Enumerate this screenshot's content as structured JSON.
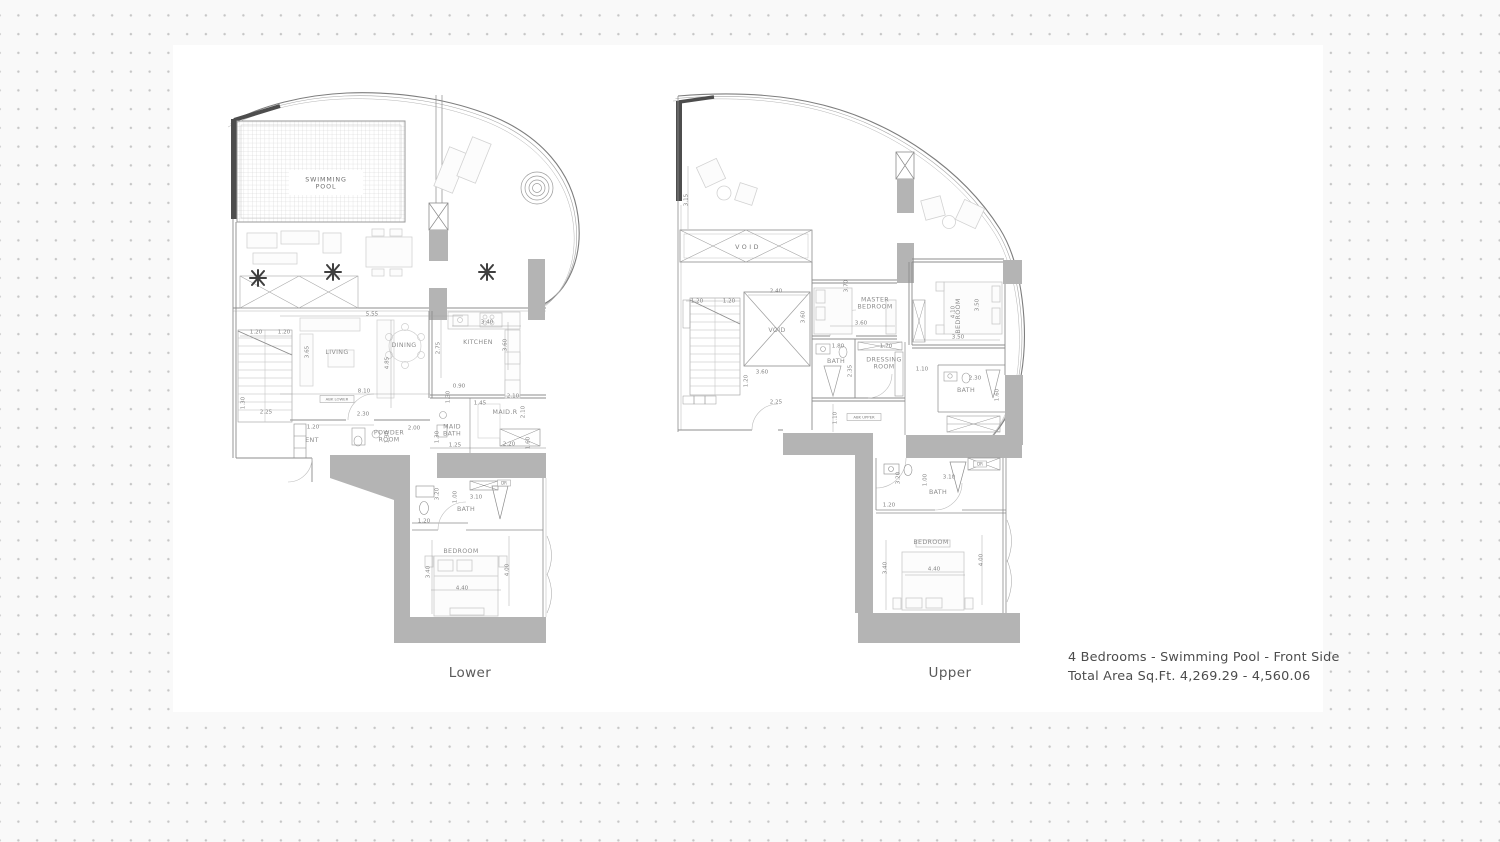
{
  "footer": {
    "line1": "4 Bedrooms - Swimming Pool - Front Side",
    "line2": "Total Area Sq.Ft.  4,269.29 - 4,560.06"
  },
  "plans": [
    {
      "caption": "Lower",
      "rooms": [
        {
          "label": "SWIMMING POOL",
          "lines": [
            "SWIMMING",
            "POOL"
          ],
          "x": 326,
          "y": 183,
          "size": 6.8,
          "cls": "poolname"
        },
        {
          "label": "LIVING",
          "x": 337,
          "y": 352
        },
        {
          "label": "DINING",
          "x": 404,
          "y": 345
        },
        {
          "label": "KITCHEN",
          "x": 478,
          "y": 342
        },
        {
          "label": "MAID.R",
          "x": 505,
          "y": 412,
          "size": 5.4
        },
        {
          "label": "MAID BATH",
          "lines": [
            "MAID",
            "BATH"
          ],
          "x": 452,
          "y": 430,
          "size": 4.8
        },
        {
          "label": "POWDER ROOM",
          "lines": [
            "POWDER",
            "ROOM"
          ],
          "x": 389,
          "y": 436,
          "size": 5.2
        },
        {
          "label": "ENT",
          "x": 312,
          "y": 440,
          "size": 5.2
        },
        {
          "label": "BATH",
          "x": 466,
          "y": 509,
          "size": 5.2
        },
        {
          "label": "BEDROOM",
          "x": 461,
          "y": 551
        }
      ],
      "dims": [
        {
          "t": "1.20",
          "x": 256,
          "y": 332
        },
        {
          "t": "1.20",
          "x": 284,
          "y": 332
        },
        {
          "t": "5.55",
          "x": 372,
          "y": 314
        },
        {
          "t": "3.40",
          "x": 487,
          "y": 322
        },
        {
          "t": "2.75",
          "x": 438,
          "y": 348,
          "rot": -90
        },
        {
          "t": "4.85",
          "x": 387,
          "y": 363,
          "rot": -90
        },
        {
          "t": "3.65",
          "x": 307,
          "y": 352,
          "rot": -90
        },
        {
          "t": "3.60",
          "x": 505,
          "y": 345,
          "rot": -90
        },
        {
          "t": "8.10",
          "x": 364,
          "y": 391
        },
        {
          "t": "0.90",
          "x": 459,
          "y": 386
        },
        {
          "t": "1.30",
          "x": 448,
          "y": 397,
          "rot": -90
        },
        {
          "t": "1.45",
          "x": 480,
          "y": 403
        },
        {
          "t": "2.10",
          "x": 513,
          "y": 396
        },
        {
          "t": "2.10",
          "x": 523,
          "y": 412,
          "rot": -90
        },
        {
          "t": "2.30",
          "x": 363,
          "y": 414
        },
        {
          "t": "2.25",
          "x": 266,
          "y": 412
        },
        {
          "t": "1.30",
          "x": 243,
          "y": 403,
          "rot": -90
        },
        {
          "t": "1.20",
          "x": 313,
          "y": 427
        },
        {
          "t": "2.00",
          "x": 414,
          "y": 428
        },
        {
          "t": "1.30",
          "x": 387,
          "y": 437,
          "rot": -90
        },
        {
          "t": "1.30",
          "x": 437,
          "y": 437,
          "rot": -90
        },
        {
          "t": "1.25",
          "x": 455,
          "y": 445
        },
        {
          "t": "2.20",
          "x": 509,
          "y": 444
        },
        {
          "t": "1.60",
          "x": 528,
          "y": 443,
          "rot": -90
        },
        {
          "t": "1.20",
          "x": 424,
          "y": 521
        },
        {
          "t": "3.20",
          "x": 437,
          "y": 494,
          "rot": -90
        },
        {
          "t": "3.10",
          "x": 476,
          "y": 497
        },
        {
          "t": "1.00",
          "x": 455,
          "y": 497,
          "rot": -90
        },
        {
          "t": "3.40",
          "x": 428,
          "y": 572,
          "rot": -90
        },
        {
          "t": "4.40",
          "x": 462,
          "y": 588
        },
        {
          "t": "4.00",
          "x": 507,
          "y": 570,
          "rot": -90
        }
      ],
      "tags": [
        {
          "t": "ABK LOWER",
          "x": 337,
          "y": 399,
          "w": 34,
          "h": 7,
          "size": 3.8
        },
        {
          "t": "DR",
          "x": 504,
          "y": 483,
          "w": 13,
          "h": 6,
          "size": 4
        }
      ]
    },
    {
      "caption": "Upper",
      "rooms": [
        {
          "label": "VOID",
          "x": 748,
          "y": 247,
          "size": 13,
          "cls": "void-big"
        },
        {
          "label": "VOID",
          "x": 777,
          "y": 330,
          "size": 5.6
        },
        {
          "label": "MASTER BEDROOM",
          "lines": [
            "MASTER",
            "BEDROOM"
          ],
          "x": 875,
          "y": 303,
          "size": 5.6
        },
        {
          "label": "BEDROOM",
          "x": 958,
          "y": 316,
          "rot": -90,
          "size": 5.6
        },
        {
          "label": "BATH",
          "x": 836,
          "y": 361,
          "size": 5
        },
        {
          "label": "DRESSING ROOM",
          "lines": [
            "DRESSING",
            "ROOM"
          ],
          "x": 884,
          "y": 363,
          "size": 5
        },
        {
          "label": "BATH",
          "x": 966,
          "y": 390,
          "size": 5
        },
        {
          "label": "BATH",
          "x": 938,
          "y": 492,
          "size": 5
        },
        {
          "label": "BEDROOM",
          "x": 931,
          "y": 542
        }
      ],
      "dims": [
        {
          "t": "3.15",
          "x": 686,
          "y": 200,
          "rot": -90
        },
        {
          "t": "1.20",
          "x": 697,
          "y": 301
        },
        {
          "t": "1.20",
          "x": 729,
          "y": 301
        },
        {
          "t": "2.40",
          "x": 776,
          "y": 291
        },
        {
          "t": "3.60",
          "x": 803,
          "y": 317,
          "rot": -90
        },
        {
          "t": "3.70",
          "x": 846,
          "y": 286,
          "rot": -90
        },
        {
          "t": "3.60",
          "x": 861,
          "y": 323
        },
        {
          "t": "1.80",
          "x": 838,
          "y": 346
        },
        {
          "t": "1.70",
          "x": 886,
          "y": 346
        },
        {
          "t": "2.35",
          "x": 850,
          "y": 371,
          "rot": -90
        },
        {
          "t": "4.10",
          "x": 953,
          "y": 312,
          "rot": -90
        },
        {
          "t": "3.50",
          "x": 977,
          "y": 305,
          "rot": -90
        },
        {
          "t": "3.50",
          "x": 958,
          "y": 337
        },
        {
          "t": "3.60",
          "x": 762,
          "y": 372
        },
        {
          "t": "1.20",
          "x": 746,
          "y": 381,
          "rot": -90
        },
        {
          "t": "2.25",
          "x": 776,
          "y": 402
        },
        {
          "t": "1.10",
          "x": 835,
          "y": 418,
          "rot": -90
        },
        {
          "t": "1.10",
          "x": 922,
          "y": 369
        },
        {
          "t": "2.30",
          "x": 975,
          "y": 378
        },
        {
          "t": "1.60",
          "x": 997,
          "y": 395,
          "rot": -90
        },
        {
          "t": "3.20",
          "x": 898,
          "y": 478,
          "rot": -90
        },
        {
          "t": "1.00",
          "x": 925,
          "y": 480,
          "rot": -90
        },
        {
          "t": "3.10",
          "x": 949,
          "y": 477
        },
        {
          "t": "1.20",
          "x": 889,
          "y": 505
        },
        {
          "t": "3.40",
          "x": 885,
          "y": 568,
          "rot": -90
        },
        {
          "t": "4.40",
          "x": 934,
          "y": 569
        },
        {
          "t": "4.00",
          "x": 981,
          "y": 560,
          "rot": -90
        }
      ],
      "tags": [
        {
          "t": "ABK UPPER",
          "x": 864,
          "y": 417,
          "w": 34,
          "h": 7,
          "size": 3.8
        },
        {
          "t": "DR",
          "x": 980,
          "y": 464,
          "w": 13,
          "h": 6,
          "size": 4
        }
      ]
    }
  ]
}
